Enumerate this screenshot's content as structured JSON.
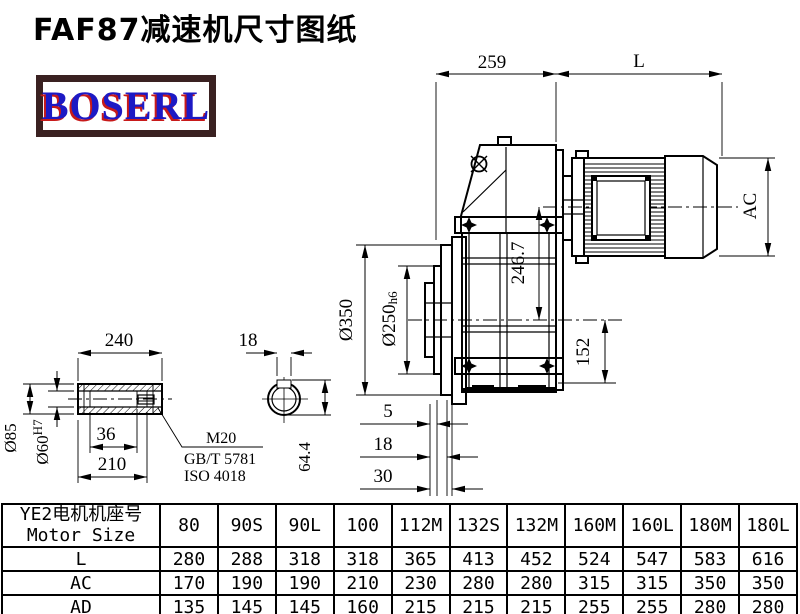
{
  "page": {
    "title": "FAF87减速机尺寸图纸"
  },
  "logo": {
    "text": "BOSERL"
  },
  "colors": {
    "line": "#000000",
    "logo_border": "#3a2121",
    "logo_text": "#1d19c4",
    "logo_shadow": "#c81a1a",
    "background": "#ffffff"
  },
  "main_view": {
    "dims": {
      "width_259": "259",
      "motor_length": "L",
      "motor_diameter": "AC",
      "flange_diameter": "Ø350",
      "spigot_diameter": "Ø250",
      "spigot_tolerance": "h6",
      "axis_distance": "246.7",
      "foot_height": "152",
      "step_5": "5",
      "step_18": "18",
      "step_30": "30"
    }
  },
  "shaft_view": {
    "dims": {
      "length_240": "240",
      "outer_diameter": "Ø85",
      "bore_diameter": "Ø60",
      "bore_tolerance": "H7",
      "fit_36": "36",
      "depth_210": "210"
    },
    "notes": {
      "thread": "M20",
      "standard_gb": "GB/T 5781",
      "standard_iso": "ISO 4018"
    }
  },
  "keyway_view": {
    "dims": {
      "key_width": "18",
      "keyway_height": "64.4"
    }
  },
  "table": {
    "header_cn": "YE2电机机座号",
    "header_en": "Motor Size",
    "columns": [
      "80",
      "90S",
      "90L",
      "100",
      "112M",
      "132S",
      "132M",
      "160M",
      "160L",
      "180M",
      "180L"
    ],
    "rows": [
      {
        "label": "L",
        "values": [
          280,
          288,
          318,
          318,
          365,
          413,
          452,
          524,
          547,
          583,
          616
        ]
      },
      {
        "label": "AC",
        "values": [
          170,
          190,
          190,
          210,
          230,
          280,
          280,
          315,
          315,
          350,
          350
        ]
      },
      {
        "label": "AD",
        "values": [
          135,
          145,
          145,
          160,
          215,
          215,
          215,
          255,
          255,
          280,
          280
        ]
      }
    ]
  }
}
